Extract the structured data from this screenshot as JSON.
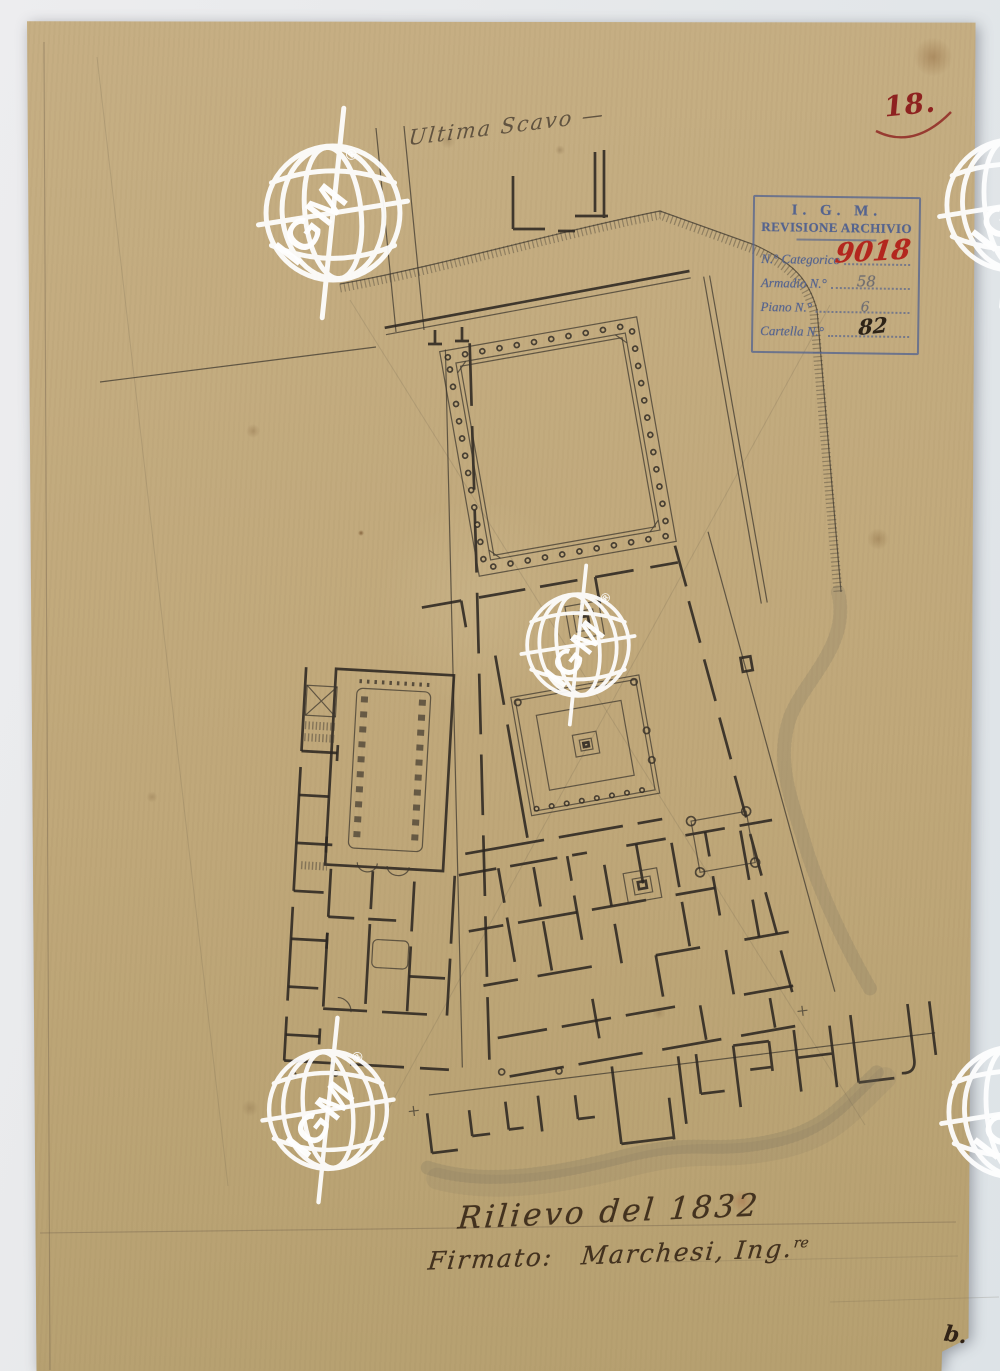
{
  "page": {
    "folio_number": "18.",
    "corner_mark": "b."
  },
  "inscriptions": {
    "top_note": "Ultima Scavo —",
    "survey_title": "Rilievo del 1832",
    "signature_prefix": "Firmato:",
    "signature_name": "Marchesi, Ing.",
    "signature_superscript": "re"
  },
  "archive_stamp": {
    "org": "I. G. M.",
    "title": "REVISIONE ARCHIVIO",
    "fields": [
      {
        "label": "N.° Categorico",
        "value": "9018"
      },
      {
        "label": "Armadio N.°",
        "value": "58"
      },
      {
        "label": "Piano N.°",
        "value": "6"
      },
      {
        "label": "Cartella N.°",
        "value": "82"
      }
    ]
  },
  "watermark": {
    "text": "IGM",
    "registered_mark": "®"
  },
  "palette": {
    "paper": "#c2ab7e",
    "backdrop": "#e6e9ec",
    "ink": "#332d26",
    "pencil": "#6b5d49",
    "stamp_blue": "#55648f",
    "red_ink": "#a3231d"
  }
}
